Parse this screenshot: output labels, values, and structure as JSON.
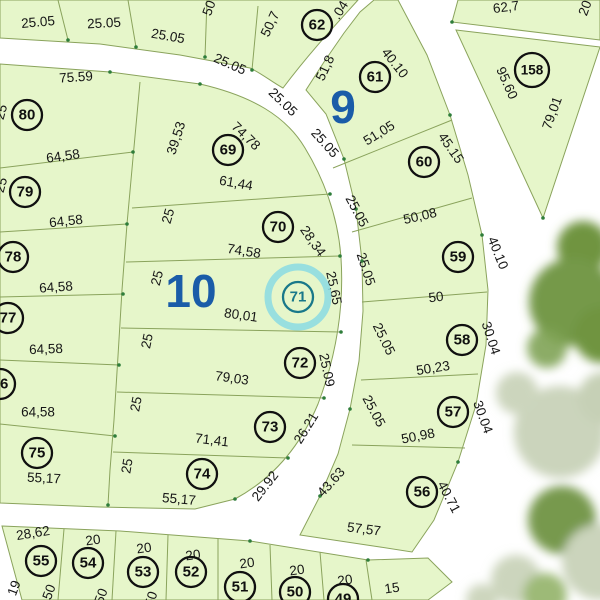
{
  "map": {
    "type": "cadastral-plat",
    "highlight": {
      "lot": "71",
      "ring_color": "#8adbe3",
      "text_color": "#19788a"
    },
    "colors": {
      "parcel": "#e6f6ca",
      "boundary_line": "#8aa35c",
      "road": "#ffffff",
      "lot_circle": "#101010",
      "block_label": "#1a5ca8",
      "vertex_dot": "#2e7d3a",
      "tree_dark": "#6f9440",
      "tree_pale": "#cbd4bc"
    },
    "blocks": [
      {
        "id": "9",
        "x": 343,
        "y": 107
      },
      {
        "id": "10",
        "x": 191,
        "y": 291
      }
    ],
    "lots": [
      {
        "id": "80",
        "x": 27,
        "y": 115
      },
      {
        "id": "79",
        "x": 25,
        "y": 192
      },
      {
        "id": "78",
        "x": 13,
        "y": 257
      },
      {
        "id": "77",
        "x": 8,
        "y": 318
      },
      {
        "id": "76",
        "x": 0,
        "y": 384
      },
      {
        "id": "75",
        "x": 37,
        "y": 453
      },
      {
        "id": "69",
        "x": 228,
        "y": 150
      },
      {
        "id": "70",
        "x": 278,
        "y": 227
      },
      {
        "id": "71",
        "x": 298,
        "y": 297
      },
      {
        "id": "72",
        "x": 300,
        "y": 363
      },
      {
        "id": "73",
        "x": 270,
        "y": 427
      },
      {
        "id": "74",
        "x": 202,
        "y": 474
      },
      {
        "id": "62",
        "x": 317,
        "y": 25
      },
      {
        "id": "61",
        "x": 375,
        "y": 77
      },
      {
        "id": "60",
        "x": 424,
        "y": 162
      },
      {
        "id": "59",
        "x": 458,
        "y": 257
      },
      {
        "id": "58",
        "x": 462,
        "y": 340
      },
      {
        "id": "57",
        "x": 453,
        "y": 412
      },
      {
        "id": "56",
        "x": 422,
        "y": 492
      },
      {
        "id": "158",
        "x": 532,
        "y": 70
      },
      {
        "id": "55",
        "x": 41,
        "y": 561
      },
      {
        "id": "54",
        "x": 88,
        "y": 563
      },
      {
        "id": "53",
        "x": 143,
        "y": 572
      },
      {
        "id": "52",
        "x": 191,
        "y": 572
      },
      {
        "id": "51",
        "x": 240,
        "y": 587
      },
      {
        "id": "50",
        "x": 295,
        "y": 592
      },
      {
        "id": "49",
        "x": 343,
        "y": 599
      }
    ],
    "dimensions": [
      {
        "t": "25.05",
        "x": 38,
        "y": 22,
        "r": -5
      },
      {
        "t": "25.05",
        "x": 104,
        "y": 23,
        "r": -3
      },
      {
        "t": "25.05",
        "x": 168,
        "y": 36,
        "r": 10
      },
      {
        "t": "25.05",
        "x": 230,
        "y": 64,
        "r": 24
      },
      {
        "t": "25.05",
        "x": 283,
        "y": 102,
        "r": 44
      },
      {
        "t": "50",
        "x": 209,
        "y": 8,
        "r": -70
      },
      {
        "t": "50,7",
        "x": 270,
        "y": 24,
        "r": -65
      },
      {
        "t": ".04",
        "x": 340,
        "y": 10,
        "r": -58
      },
      {
        "t": "51,8",
        "x": 325,
        "y": 68,
        "r": -65
      },
      {
        "t": "40.10",
        "x": 395,
        "y": 63,
        "r": 52
      },
      {
        "t": "51,05",
        "x": 379,
        "y": 133,
        "r": -32
      },
      {
        "t": "25.05",
        "x": 325,
        "y": 143,
        "r": 48
      },
      {
        "t": "45.15",
        "x": 451,
        "y": 148,
        "r": 55
      },
      {
        "t": "25.05",
        "x": 357,
        "y": 211,
        "r": 62
      },
      {
        "t": "50,08",
        "x": 420,
        "y": 216,
        "r": -13
      },
      {
        "t": "25.05",
        "x": 366,
        "y": 269,
        "r": 72
      },
      {
        "t": "40.10",
        "x": 498,
        "y": 253,
        "r": 68
      },
      {
        "t": "50",
        "x": 436,
        "y": 297,
        "r": -7
      },
      {
        "t": "25.05",
        "x": 384,
        "y": 339,
        "r": 64
      },
      {
        "t": "30.04",
        "x": 491,
        "y": 338,
        "r": 72
      },
      {
        "t": "50,23",
        "x": 433,
        "y": 368,
        "r": -9
      },
      {
        "t": "25.05",
        "x": 374,
        "y": 411,
        "r": 62
      },
      {
        "t": "30.04",
        "x": 483,
        "y": 417,
        "r": 70
      },
      {
        "t": "50,98",
        "x": 418,
        "y": 436,
        "r": -11
      },
      {
        "t": "40.71",
        "x": 449,
        "y": 497,
        "r": 62
      },
      {
        "t": "43.63",
        "x": 331,
        "y": 482,
        "r": -48
      },
      {
        "t": "57,57",
        "x": 364,
        "y": 529,
        "r": 7
      },
      {
        "t": "75.59",
        "x": 76,
        "y": 77,
        "r": -4
      },
      {
        "t": "64,58",
        "x": 63,
        "y": 156,
        "r": -8
      },
      {
        "t": "64,58",
        "x": 66,
        "y": 221,
        "r": -6
      },
      {
        "t": "64,58",
        "x": 56,
        "y": 287,
        "r": -4
      },
      {
        "t": "64,58",
        "x": 46,
        "y": 349,
        "r": -2
      },
      {
        "t": "64,58",
        "x": 38,
        "y": 412,
        "r": 0
      },
      {
        "t": "55,17",
        "x": 44,
        "y": 478,
        "r": 3
      },
      {
        "t": "39,53",
        "x": 176,
        "y": 138,
        "r": -72
      },
      {
        "t": "74,78",
        "x": 246,
        "y": 136,
        "r": 44
      },
      {
        "t": "61,44",
        "x": 236,
        "y": 183,
        "r": 10
      },
      {
        "t": "25",
        "x": 168,
        "y": 216,
        "r": -74
      },
      {
        "t": "28,34",
        "x": 313,
        "y": 241,
        "r": 55
      },
      {
        "t": "74,58",
        "x": 244,
        "y": 251,
        "r": 9
      },
      {
        "t": "25",
        "x": 157,
        "y": 278,
        "r": -76
      },
      {
        "t": "25,65",
        "x": 334,
        "y": 288,
        "r": 78
      },
      {
        "t": "80,01",
        "x": 241,
        "y": 315,
        "r": 8
      },
      {
        "t": "25",
        "x": 147,
        "y": 341,
        "r": -78
      },
      {
        "t": "25.09",
        "x": 327,
        "y": 370,
        "r": 78
      },
      {
        "t": "79,03",
        "x": 232,
        "y": 378,
        "r": 8
      },
      {
        "t": "25",
        "x": 136,
        "y": 404,
        "r": -79
      },
      {
        "t": "26.21",
        "x": 306,
        "y": 428,
        "r": -58
      },
      {
        "t": "71,41",
        "x": 212,
        "y": 440,
        "r": 7
      },
      {
        "t": "25",
        "x": 127,
        "y": 466,
        "r": -80
      },
      {
        "t": "29.92",
        "x": 265,
        "y": 486,
        "r": -52
      },
      {
        "t": "55,17",
        "x": 179,
        "y": 499,
        "r": 5
      },
      {
        "t": "25",
        "x": 1,
        "y": 112,
        "r": -75
      },
      {
        "t": "25",
        "x": 1,
        "y": 185,
        "r": -75
      },
      {
        "t": "28,62",
        "x": 33,
        "y": 533,
        "r": -9
      },
      {
        "t": "20",
        "x": 93,
        "y": 540,
        "r": -8
      },
      {
        "t": "20",
        "x": 144,
        "y": 548,
        "r": -8
      },
      {
        "t": "20",
        "x": 193,
        "y": 555,
        "r": -8
      },
      {
        "t": "20",
        "x": 247,
        "y": 563,
        "r": -8
      },
      {
        "t": "20",
        "x": 297,
        "y": 570,
        "r": -8
      },
      {
        "t": "20",
        "x": 345,
        "y": 580,
        "r": -8
      },
      {
        "t": "15",
        "x": 392,
        "y": 588,
        "r": -8
      },
      {
        "t": "19",
        "x": 14,
        "y": 588,
        "r": -70
      },
      {
        "t": "50",
        "x": 49,
        "y": 592,
        "r": -70
      },
      {
        "t": "50",
        "x": 101,
        "y": 596,
        "r": -70
      },
      {
        "t": "50",
        "x": 151,
        "y": 599,
        "r": -72
      },
      {
        "t": "62,7",
        "x": 506,
        "y": 7,
        "r": -7
      },
      {
        "t": "20",
        "x": 585,
        "y": 8,
        "r": -70
      },
      {
        "t": "95.60",
        "x": 507,
        "y": 83,
        "r": 66
      },
      {
        "t": "79,01",
        "x": 552,
        "y": 113,
        "r": -70
      }
    ]
  }
}
